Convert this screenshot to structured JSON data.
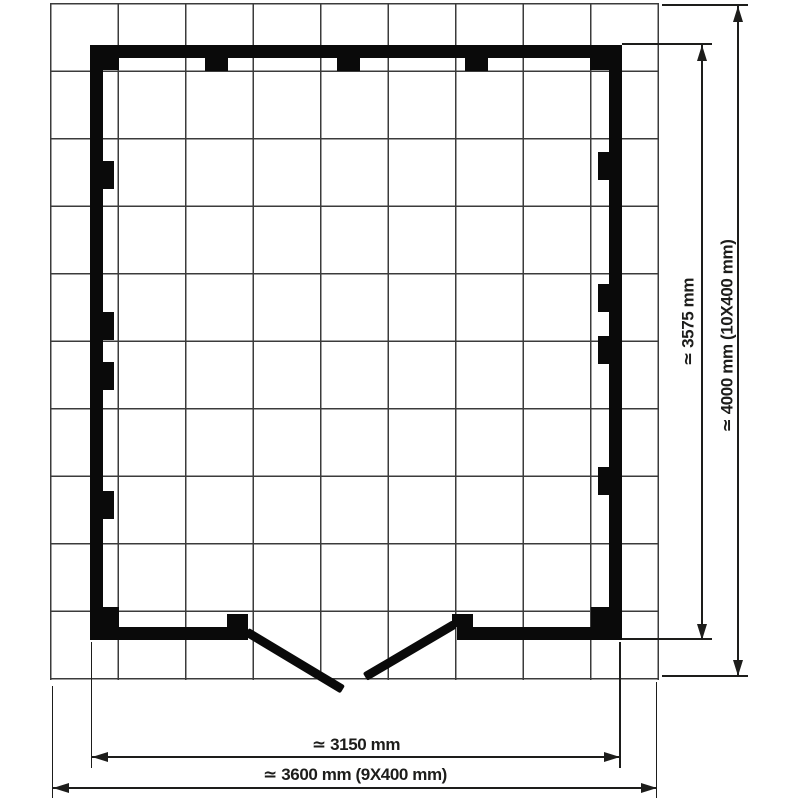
{
  "diagram": {
    "kind": "floor-plan",
    "grid": {
      "columns": 9,
      "rows": 10,
      "cell_mm": 400
    },
    "dimensions": {
      "inner_width_label": "≃ 3150 mm",
      "outer_width_label": "≃ 3600 mm (9X400 mm)",
      "inner_height_label": "≃ 3575 mm",
      "outer_height_label": "≃ 4000 mm (10X400 mm)"
    },
    "colors": {
      "wall": "#0a0a0a",
      "dimension_line": "#1d1d1b",
      "grid_line": "#3b3b3b",
      "background": "#ffffff"
    },
    "plan": {
      "blocks": [
        {
          "name": "wall-top",
          "x": 90,
          "y": 45,
          "w": 532,
          "h": 13
        },
        {
          "name": "wall-left",
          "x": 90,
          "y": 45,
          "w": 13,
          "h": 595
        },
        {
          "name": "wall-right",
          "x": 609,
          "y": 45,
          "w": 13,
          "h": 595
        },
        {
          "name": "wall-bottom-left",
          "x": 90,
          "y": 627,
          "w": 158,
          "h": 13
        },
        {
          "name": "wall-bottom-right",
          "x": 457,
          "y": 627,
          "w": 165,
          "h": 13
        },
        {
          "name": "corner-joint-top-left",
          "x": 103,
          "y": 58,
          "w": 16,
          "h": 12
        },
        {
          "name": "corner-joint-top-right",
          "x": 590,
          "y": 58,
          "w": 19,
          "h": 12
        },
        {
          "name": "corner-joint-bottom-left",
          "x": 103,
          "y": 607,
          "w": 16,
          "h": 20
        },
        {
          "name": "corner-joint-bottom-right",
          "x": 591,
          "y": 607,
          "w": 18,
          "h": 20
        },
        {
          "name": "wall-tab-top-1",
          "x": 205,
          "y": 58,
          "w": 23,
          "h": 13
        },
        {
          "name": "wall-tab-top-2",
          "x": 337,
          "y": 58,
          "w": 23,
          "h": 13
        },
        {
          "name": "wall-tab-top-3",
          "x": 465,
          "y": 58,
          "w": 23,
          "h": 13
        },
        {
          "name": "wall-tab-left-1",
          "x": 103,
          "y": 161,
          "w": 11,
          "h": 28
        },
        {
          "name": "wall-tab-left-2",
          "x": 103,
          "y": 312,
          "w": 11,
          "h": 28
        },
        {
          "name": "wall-tab-left-3",
          "x": 103,
          "y": 362,
          "w": 11,
          "h": 28
        },
        {
          "name": "wall-tab-left-4",
          "x": 103,
          "y": 491,
          "w": 11,
          "h": 28
        },
        {
          "name": "wall-tab-right-1",
          "x": 598,
          "y": 152,
          "w": 11,
          "h": 28
        },
        {
          "name": "wall-tab-right-2",
          "x": 598,
          "y": 284,
          "w": 11,
          "h": 28
        },
        {
          "name": "wall-tab-right-3",
          "x": 598,
          "y": 336,
          "w": 11,
          "h": 28
        },
        {
          "name": "wall-tab-right-4",
          "x": 598,
          "y": 467,
          "w": 11,
          "h": 28
        },
        {
          "name": "wall-tab-door-jamb-left",
          "x": 227,
          "y": 614,
          "w": 21,
          "h": 13
        },
        {
          "name": "wall-tab-door-jamb-right",
          "x": 452,
          "y": 614,
          "w": 21,
          "h": 13
        },
        {
          "name": "door-leaf-left",
          "x": 249,
          "y": 628,
          "w": 112,
          "h": 9,
          "rot": 31
        },
        {
          "name": "door-leaf-right",
          "x": 457,
          "y": 628,
          "w": 104,
          "h": 9,
          "rot": 149.5
        }
      ]
    }
  }
}
